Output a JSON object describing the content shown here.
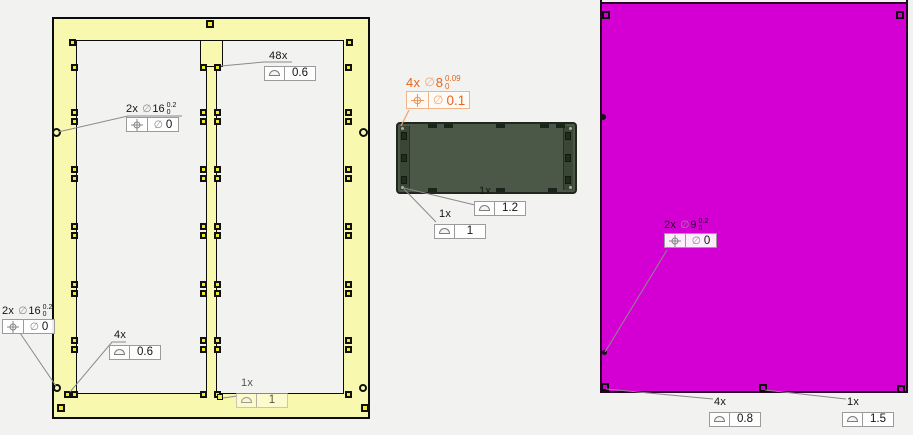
{
  "symbols": {
    "diameter": "∅"
  },
  "colors": {
    "background": "#f2f2f1",
    "frame_yellow": "#f8f8ae",
    "board_green": "#4c5847",
    "panel_magenta": "#d400d3",
    "accent_orange": "#e8661c"
  },
  "callouts": {
    "frame_profile_all": {
      "qty": "48x",
      "symbol": "profile",
      "value": "0.6"
    },
    "frame_pos_d16_mid": {
      "qty": "2x",
      "symbol": "position",
      "dim": "16",
      "tol_top": "0.2",
      "tol_bottom": "0",
      "value": "0"
    },
    "frame_pos_d16_low": {
      "qty": "2x",
      "symbol": "position",
      "dim": "16",
      "tol_top": "0.2",
      "tol_bottom": "0",
      "value": "0"
    },
    "frame_profile_corner": {
      "qty": "4x",
      "symbol": "profile",
      "value": "0.6"
    },
    "frame_profile_single": {
      "qty": "1x",
      "symbol": "profile",
      "value": "1"
    },
    "board_pos_d8": {
      "qty": "4x",
      "symbol": "position",
      "dim": "8",
      "tol_top": "0.09",
      "tol_bottom": "0",
      "value": "0.1"
    },
    "board_profile_a": {
      "qty": "1x",
      "symbol": "profile",
      "value": "1.2"
    },
    "board_profile_b": {
      "qty": "1x",
      "symbol": "profile",
      "value": "1"
    },
    "panel_pos_d9": {
      "qty": "2x",
      "symbol": "position",
      "dim": "9",
      "tol_top": "0.2",
      "tol_bottom": "0",
      "value": "0"
    },
    "panel_profile_corner": {
      "qty": "4x",
      "symbol": "profile",
      "value": "0.8"
    },
    "panel_profile_single": {
      "qty": "1x",
      "symbol": "profile",
      "value": "1.5"
    }
  }
}
